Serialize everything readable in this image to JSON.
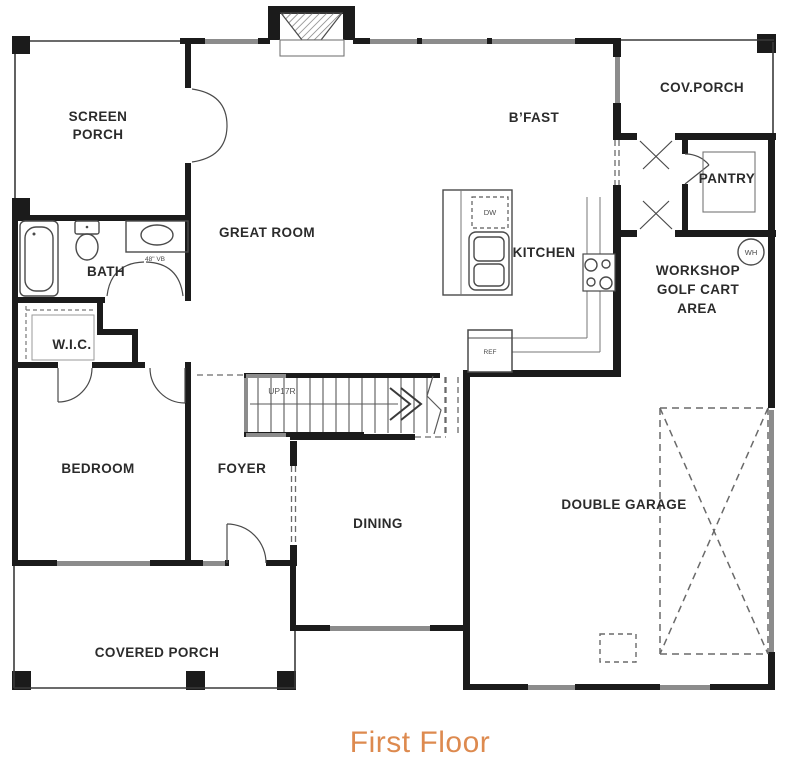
{
  "caption": "First Floor",
  "colors": {
    "wall": "#1b1b1b",
    "window": "#8c8c8c",
    "fixture_line": "#4a4a4a",
    "dashed_line": "#6a6a6a",
    "label": "#2b2b2b",
    "accent": "#dd8a4f"
  },
  "rooms": {
    "screen_porch": {
      "line1": "SCREEN",
      "line2": "PORCH"
    },
    "great_room": {
      "label": "GREAT ROOM"
    },
    "breakfast": {
      "label": "B’FAST"
    },
    "cov_porch": {
      "label": "COV.PORCH"
    },
    "pantry": {
      "label": "PANTRY"
    },
    "kitchen": {
      "label": "KITCHEN"
    },
    "workshop": {
      "line1": "WORKSHOP",
      "line2": "GOLF CART",
      "line3": "AREA"
    },
    "bath": {
      "label": "BATH"
    },
    "wic": {
      "label": "W.I.C."
    },
    "bedroom": {
      "label": "BEDROOM"
    },
    "foyer": {
      "label": "FOYER"
    },
    "dining": {
      "label": "DINING"
    },
    "garage": {
      "label": "DOUBLE GARAGE"
    },
    "covered_porch": {
      "label": "COVERED PORCH"
    }
  },
  "fixtures": {
    "vanity_label": "48\" VB",
    "dishwasher_label": "DW",
    "refrigerator_label": "REF",
    "water_heater_label": "WH",
    "stairs_label": "UP17R"
  }
}
